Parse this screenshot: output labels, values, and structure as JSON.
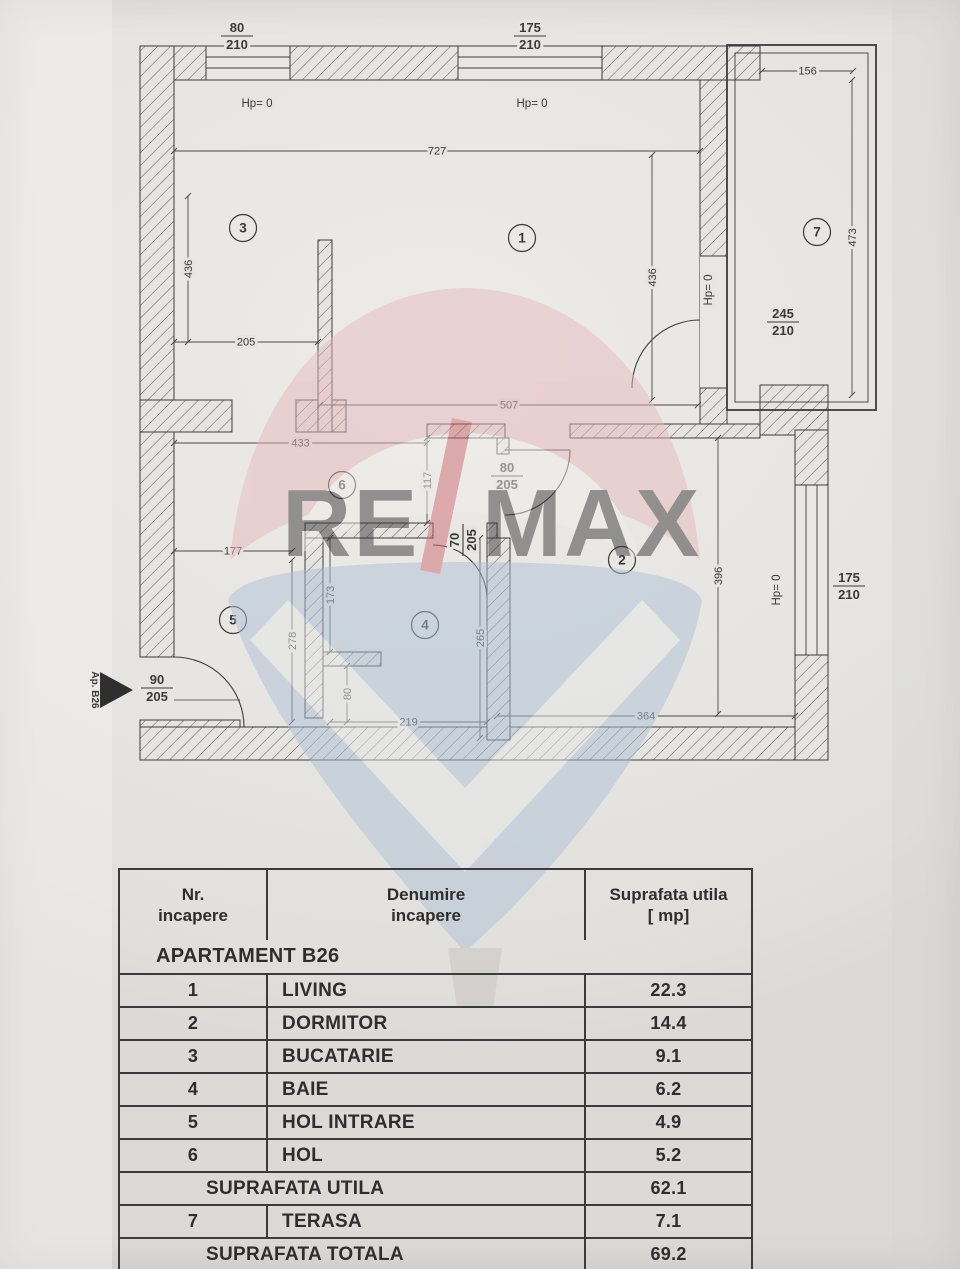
{
  "plan": {
    "entry": {
      "label": "Ap. B26"
    },
    "rooms": [
      {
        "number": "1",
        "x": 522,
        "y": 238
      },
      {
        "number": "2",
        "x": 622,
        "y": 560
      },
      {
        "number": "3",
        "x": 243,
        "y": 228
      },
      {
        "number": "4",
        "x": 425,
        "y": 625
      },
      {
        "number": "5",
        "x": 233,
        "y": 620
      },
      {
        "number": "6",
        "x": 342,
        "y": 485
      },
      {
        "number": "7",
        "x": 817,
        "y": 232
      }
    ],
    "dimensions": [
      {
        "v": "727",
        "x1": 174,
        "y1": 151,
        "x2": 700,
        "y2": 151,
        "rot": 0
      },
      {
        "v": "205",
        "x1": 174,
        "y1": 342,
        "x2": 318,
        "y2": 342,
        "rot": 0
      },
      {
        "v": "156",
        "x1": 762,
        "y1": 71,
        "x2": 853,
        "y2": 71,
        "rot": 0
      },
      {
        "v": "507",
        "x1": 320,
        "y1": 405,
        "x2": 698,
        "y2": 405,
        "rot": 0
      },
      {
        "v": "433",
        "x1": 174,
        "y1": 443,
        "x2": 427,
        "y2": 443,
        "rot": 0
      },
      {
        "v": "177",
        "x1": 174,
        "y1": 551,
        "x2": 292,
        "y2": 551,
        "rot": 0
      },
      {
        "v": "219",
        "x1": 330,
        "y1": 722,
        "x2": 487,
        "y2": 722,
        "rot": 0
      },
      {
        "v": "364",
        "x1": 497,
        "y1": 716,
        "x2": 795,
        "y2": 716,
        "rot": 0
      },
      {
        "v": "436",
        "x1": 188,
        "y1": 196,
        "x2": 188,
        "y2": 342,
        "rot": -90
      },
      {
        "v": "436",
        "x1": 652,
        "y1": 155,
        "x2": 652,
        "y2": 400,
        "rot": -90
      },
      {
        "v": "473",
        "x1": 852,
        "y1": 80,
        "x2": 852,
        "y2": 395,
        "rot": -90
      },
      {
        "v": "117",
        "x1": 427,
        "y1": 438,
        "x2": 427,
        "y2": 523,
        "rot": -90
      },
      {
        "v": "278",
        "x1": 292,
        "y1": 560,
        "x2": 292,
        "y2": 722,
        "rot": -90
      },
      {
        "v": "173",
        "x1": 330,
        "y1": 538,
        "x2": 330,
        "y2": 652,
        "rot": -90
      },
      {
        "v": "265",
        "x1": 480,
        "y1": 538,
        "x2": 480,
        "y2": 738,
        "rot": -90
      },
      {
        "v": "80",
        "x1": 347,
        "y1": 666,
        "x2": 347,
        "y2": 722,
        "rot": -90
      },
      {
        "v": "396",
        "x1": 718,
        "y1": 438,
        "x2": 718,
        "y2": 714,
        "rot": -90
      }
    ],
    "size_labels": [
      {
        "top": "80",
        "bottom": "210",
        "x": 237,
        "y": 36,
        "rot": 0
      },
      {
        "top": "175",
        "bottom": "210",
        "x": 530,
        "y": 36,
        "rot": 0
      },
      {
        "top": "245",
        "bottom": "210",
        "x": 783,
        "y": 322,
        "rot": 0
      },
      {
        "top": "80",
        "bottom": "205",
        "x": 507,
        "y": 476,
        "rot": 0
      },
      {
        "top": "70",
        "bottom": "205",
        "x": 463,
        "y": 540,
        "rot": -90
      },
      {
        "top": "90",
        "bottom": "205",
        "x": 157,
        "y": 688,
        "rot": 0
      },
      {
        "top": "175",
        "bottom": "210",
        "x": 849,
        "y": 586,
        "rot": 0
      }
    ],
    "hp_labels": [
      {
        "text": "Hp= 0",
        "x": 257,
        "y": 107,
        "rot": 0
      },
      {
        "text": "Hp= 0",
        "x": 532,
        "y": 107,
        "rot": 0
      },
      {
        "text": "Hp= 0",
        "x": 712,
        "y": 290,
        "rot": -90
      },
      {
        "text": "Hp= 0",
        "x": 780,
        "y": 590,
        "rot": -90
      }
    ]
  },
  "watermark": {
    "text_left": "RE",
    "text_slash": "/",
    "text_right": "MAX",
    "pink": "#e6b9bf",
    "red": "#cf6b74",
    "blue": "#aec2d8",
    "basket_grey": "#c8c5c1"
  },
  "table": {
    "headers": [
      "Nr.\nincapere",
      "Denumire\nincapere",
      "Suprafata utila\n[ mp]"
    ],
    "rows": [
      {
        "type": "section",
        "label": "APARTAMENT B26"
      },
      {
        "type": "room",
        "nr": "1",
        "name": "LIVING",
        "area": "22.3"
      },
      {
        "type": "room",
        "nr": "2",
        "name": "DORMITOR",
        "area": "14.4"
      },
      {
        "type": "room",
        "nr": "3",
        "name": "BUCATARIE",
        "area": "9.1"
      },
      {
        "type": "room",
        "nr": "4",
        "name": "BAIE",
        "area": "6.2"
      },
      {
        "type": "room",
        "nr": "5",
        "name": "HOL INTRARE",
        "area": "4.9"
      },
      {
        "type": "room",
        "nr": "6",
        "name": "HOL",
        "area": "5.2"
      },
      {
        "type": "total",
        "label": "SUPRAFATA UTILA",
        "area": "62.1"
      },
      {
        "type": "room",
        "nr": "7",
        "name": "TERASA",
        "area": "7.1"
      },
      {
        "type": "total",
        "label": "SUPRAFATA TOTALA",
        "area": "69.2"
      },
      {
        "type": "empty"
      }
    ]
  }
}
